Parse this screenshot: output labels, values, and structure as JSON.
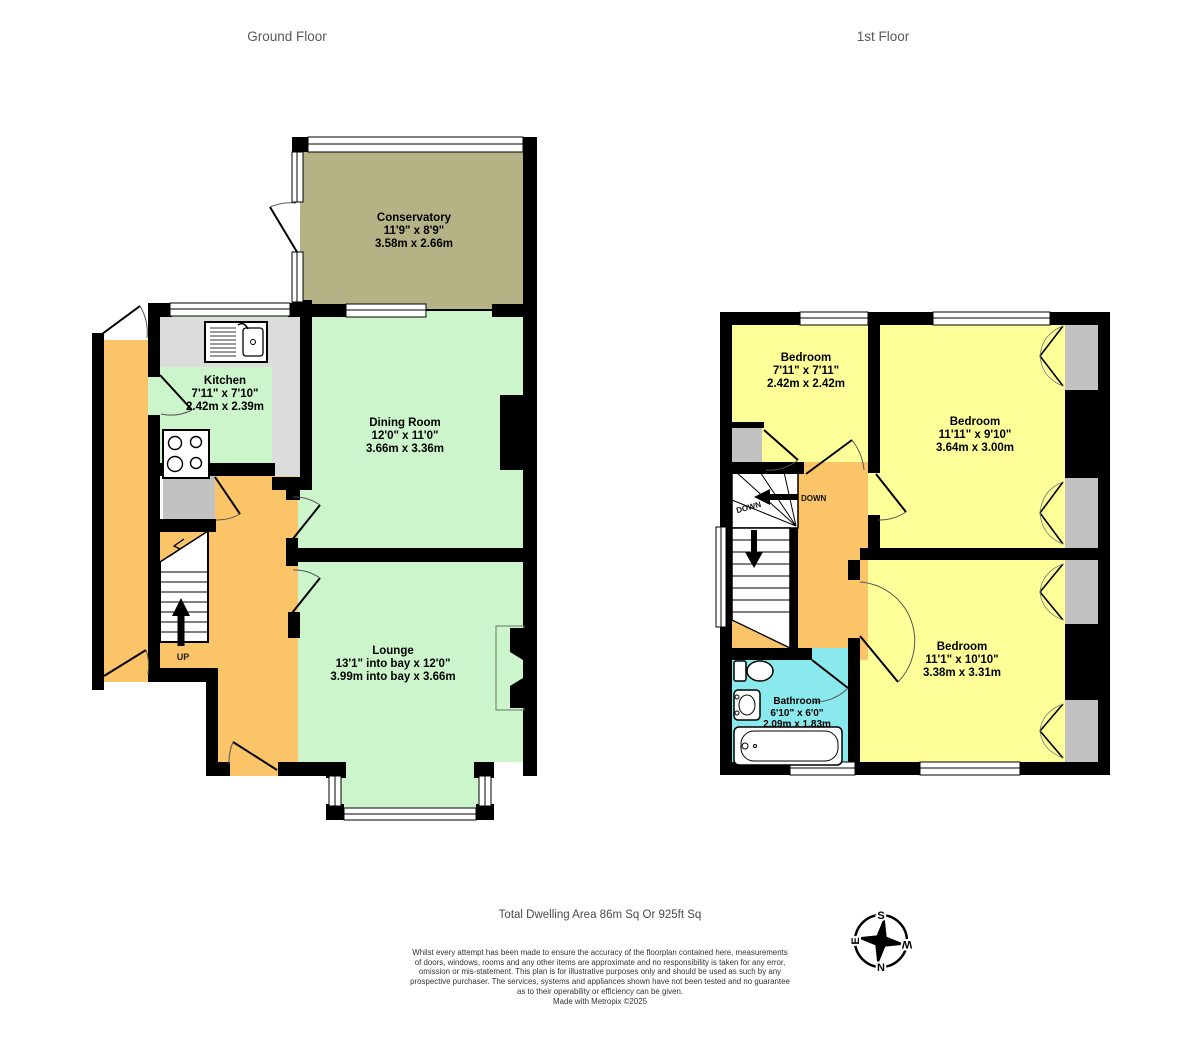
{
  "headings": {
    "ground_floor": "Ground Floor",
    "first_floor": "1st Floor"
  },
  "ground_floor": {
    "conservatory": {
      "name": "Conservatory",
      "imperial": "11'9\"  x 8'9\"",
      "metric": "3.58m  x 2.66m"
    },
    "kitchen": {
      "name": "Kitchen",
      "imperial": "7'11\"  x 7'10\"",
      "metric": "2.42m  x 2.39m"
    },
    "dining_room": {
      "name": "Dining Room",
      "imperial": "12'0\"  x 11'0\"",
      "metric": "3.66m  x 3.36m"
    },
    "lounge": {
      "name": "Lounge",
      "imperial": "13'1\" into bay x 12'0\"",
      "metric": "3.99m into bay x 3.66m"
    },
    "stairs_label": "UP"
  },
  "first_floor": {
    "bedroom_small": {
      "name": "Bedroom",
      "imperial": "7'11\"  x 7'11\"",
      "metric": "2.42m  x 2.42m"
    },
    "bedroom_front": {
      "name": "Bedroom",
      "imperial": "11'11\"  x 9'10\"",
      "metric": "3.64m  x 3.00m"
    },
    "bedroom_rear": {
      "name": "Bedroom",
      "imperial": "11'1\"  x 10'10\"",
      "metric": "3.38m  x 3.31m"
    },
    "bathroom": {
      "name": "Bathroom",
      "imperial": "6'10\"  x 6'0\"",
      "metric": "2.09m  x 1.83m"
    },
    "stairs_label_1": "DOWN",
    "stairs_label_2": "DOWN"
  },
  "footer": {
    "total_area": "Total Dwelling Area 86m Sq Or 925ft Sq",
    "disclaimer_lines": [
      "Whilst every attempt has been made to ensure the accuracy of the floorplan contained here, measurements",
      "of doors, windows, rooms and any other items are approximate and no responsibility is taken for any error,",
      "omission or mis-statement. This plan is for illustrative purposes only and should be used as such by any",
      "prospective purchaser. The services, systems and appliances shown have not been tested and no guarantee",
      "as to their operability or efficiency can be given.",
      "Made with Metropix ©2025"
    ]
  },
  "compass": {
    "north": "N",
    "south": "S",
    "east": "E",
    "west": "W"
  },
  "colors": {
    "wall": "#000000",
    "room_green": "#cdf5cb",
    "room_yellow": "#feff99",
    "hall_orange": "#fbc468",
    "bathroom_cyan": "#8ae9ec",
    "conservatory_khaki": "#b5b286",
    "fixture_grey": "#c2c2c2",
    "counter_grey": "#dcdcdc"
  }
}
